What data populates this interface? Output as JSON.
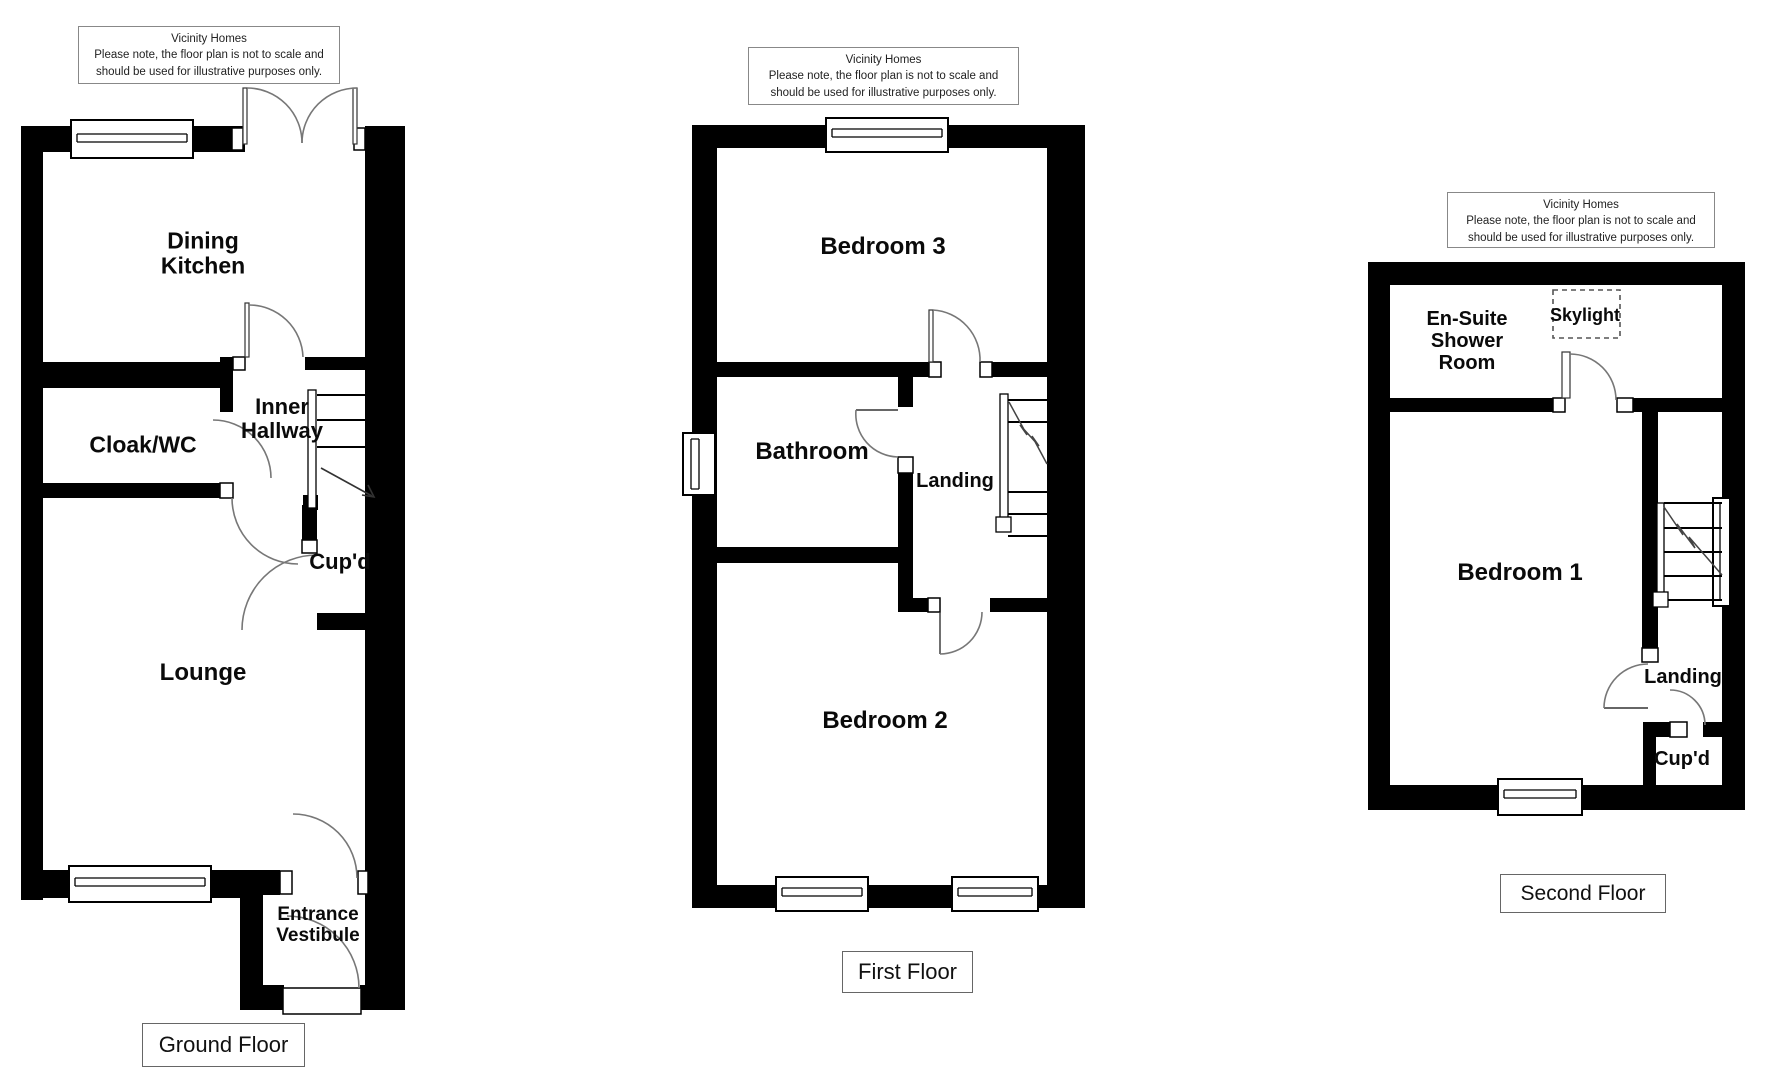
{
  "disclaimer": {
    "text": "Vicinity Homes\nPlease note, the floor plan is not to scale and\nshould be used for illustrative purposes only."
  },
  "ground_floor": {
    "title": "Ground Floor",
    "rooms": {
      "dining_kitchen": "Dining\nKitchen",
      "cloak_wc": "Cloak/WC",
      "inner_hallway": "Inner\nHallway",
      "cupboard": "Cup'd",
      "lounge": "Lounge",
      "entrance_vestibule": "Entrance\nVestibule"
    }
  },
  "first_floor": {
    "title": "First Floor",
    "rooms": {
      "bedroom3": "Bedroom 3",
      "bathroom": "Bathroom",
      "landing": "Landing",
      "bedroom2": "Bedroom 2"
    }
  },
  "second_floor": {
    "title": "Second Floor",
    "rooms": {
      "ensuite": "En-Suite\nShower\nRoom",
      "skylight": "Skylight",
      "bedroom1": "Bedroom 1",
      "landing": "Landing",
      "cupboard": "Cup'd"
    }
  },
  "colors": {
    "wall": "#000000",
    "arc_line": "#777777",
    "background": "#ffffff"
  }
}
